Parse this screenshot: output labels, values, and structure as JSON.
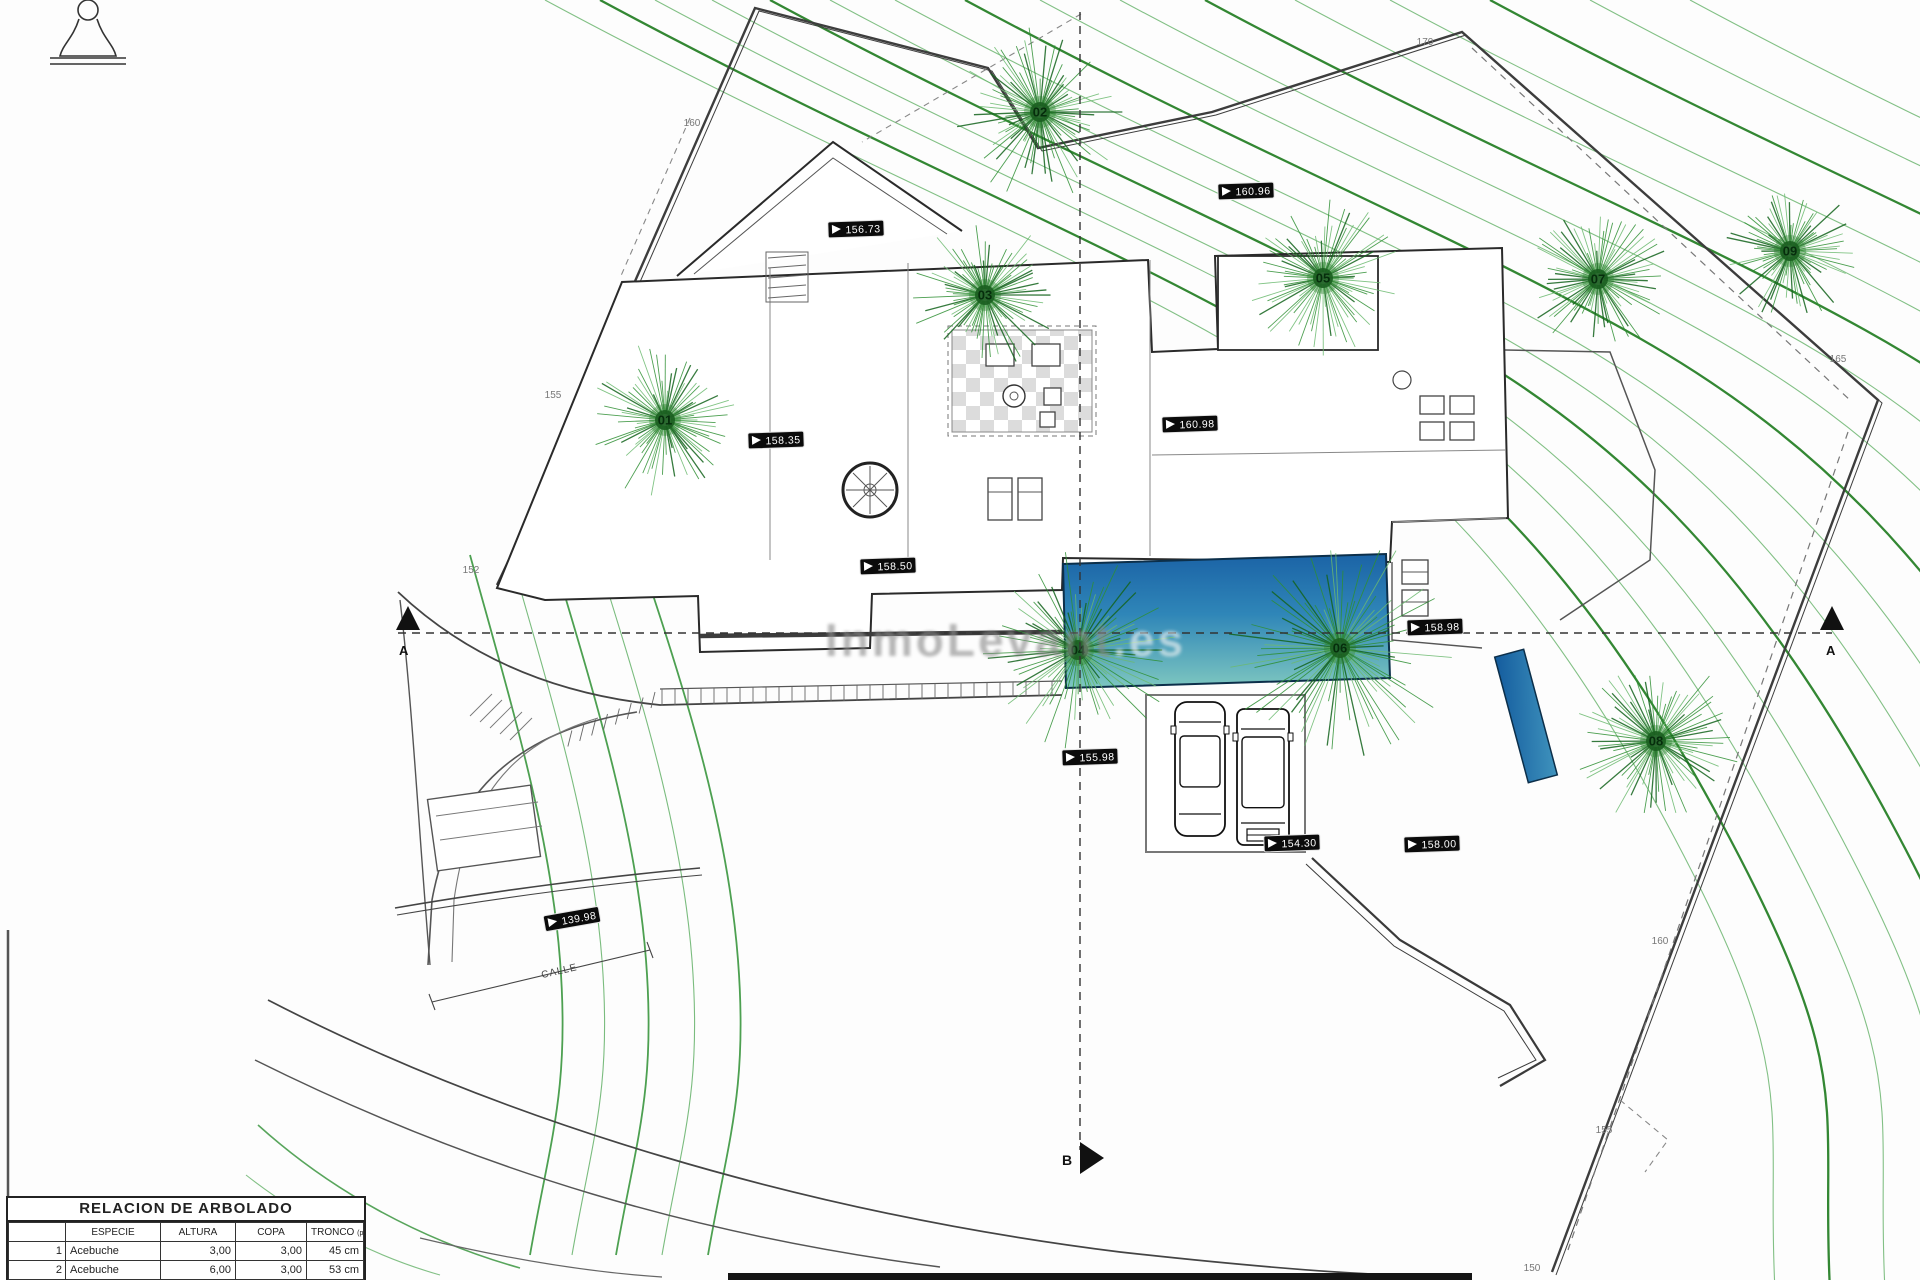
{
  "table": {
    "title": "RELACION DE ARBOLADO",
    "columns": {
      "num": "",
      "especie": "ESPECIE",
      "altura": "ALTURA",
      "copa": "COPA",
      "tronco": "TRONCO",
      "tronco_sub": "(perimetro)"
    },
    "rows": [
      {
        "num": "1",
        "especie": "Acebuche",
        "altura": "3,00",
        "copa": "3,00",
        "tronco": "45 cm"
      },
      {
        "num": "2",
        "especie": "Acebuche",
        "altura": "6,00",
        "copa": "3,00",
        "tronco": "53 cm"
      }
    ]
  },
  "trees": [
    {
      "label": "01",
      "x": 665,
      "y": 420,
      "r": 80
    },
    {
      "label": "02",
      "x": 1040,
      "y": 112,
      "r": 88
    },
    {
      "label": "03",
      "x": 985,
      "y": 295,
      "r": 75
    },
    {
      "label": "04",
      "x": 1078,
      "y": 650,
      "r": 100
    },
    {
      "label": "05",
      "x": 1323,
      "y": 278,
      "r": 80
    },
    {
      "label": "06",
      "x": 1340,
      "y": 648,
      "r": 115
    },
    {
      "label": "07",
      "x": 1598,
      "y": 279,
      "r": 72
    },
    {
      "label": "08",
      "x": 1656,
      "y": 741,
      "r": 85
    },
    {
      "label": "09",
      "x": 1790,
      "y": 251,
      "r": 68
    }
  ],
  "spot_elevations": [
    {
      "value": "156.73",
      "x": 856,
      "y": 229,
      "rot": -2
    },
    {
      "value": "160.96",
      "x": 1246,
      "y": 191,
      "rot": -2
    },
    {
      "value": "158.35",
      "x": 776,
      "y": 440,
      "rot": -2
    },
    {
      "value": "160.98",
      "x": 1190,
      "y": 424,
      "rot": -2
    },
    {
      "value": "158.50",
      "x": 888,
      "y": 566,
      "rot": -2
    },
    {
      "value": "158.98",
      "x": 1435,
      "y": 627,
      "rot": -2
    },
    {
      "value": "155.98",
      "x": 1090,
      "y": 757,
      "rot": -2
    },
    {
      "value": "154.30",
      "x": 1292,
      "y": 843,
      "rot": -2
    },
    {
      "value": "158.00",
      "x": 1432,
      "y": 844,
      "rot": -2
    },
    {
      "value": "139.98",
      "x": 572,
      "y": 919,
      "rot": -10
    }
  ],
  "contour_labels": [
    {
      "text": "160",
      "x": 692,
      "y": 126
    },
    {
      "text": "170",
      "x": 1425,
      "y": 45
    },
    {
      "text": "155",
      "x": 553,
      "y": 398
    },
    {
      "text": "152",
      "x": 471,
      "y": 573
    },
    {
      "text": "165",
      "x": 1838,
      "y": 362
    },
    {
      "text": "160",
      "x": 1660,
      "y": 944
    },
    {
      "text": "155",
      "x": 1604,
      "y": 1133
    },
    {
      "text": "150",
      "x": 1532,
      "y": 1271
    }
  ],
  "section_markers": {
    "left": "A",
    "right": "A",
    "bottom": "B"
  },
  "street_label": "CALLE",
  "watermark": {
    "left": "InmoLevant",
    "right": ".es"
  },
  "colors": {
    "contour_green": "#2e8f33",
    "pool_top": "#1b63a6",
    "pool_bottom": "#7ec7c0",
    "label_bg": "#0b0b0b",
    "boundary": "#3d3d3d"
  }
}
